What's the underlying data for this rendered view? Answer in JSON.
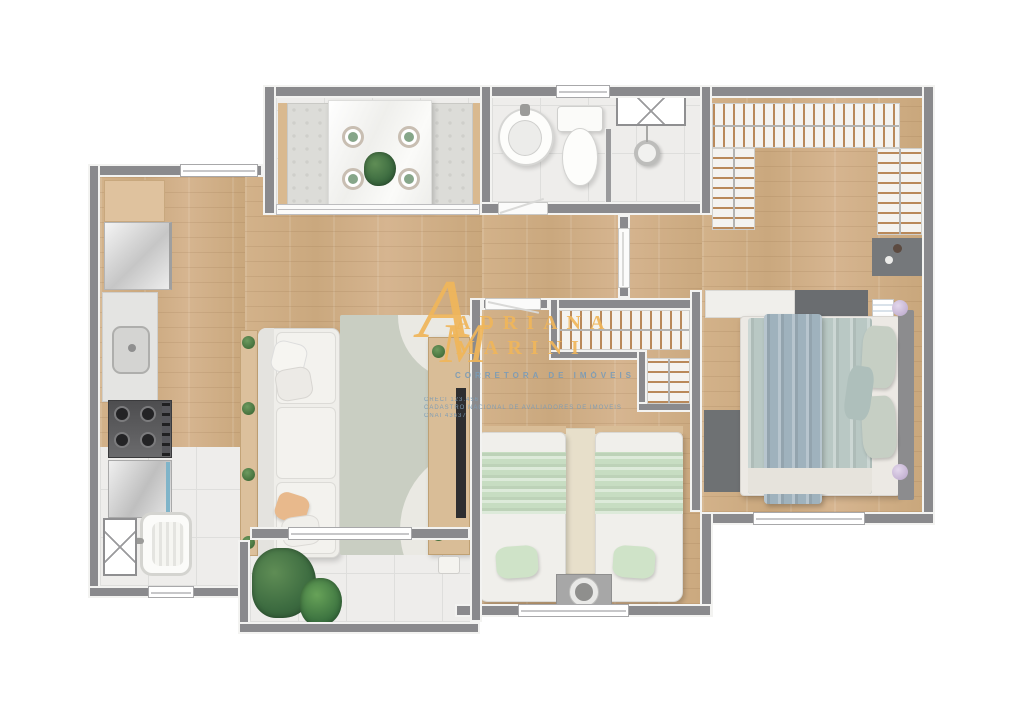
{
  "brand": {
    "monogram_letter1": "A",
    "monogram_letter2": "M",
    "name_line1": "ADRIANA",
    "name_line2": "MARINI",
    "tagline": "CORRETORA DE IMÓVEIS",
    "detail_line1": "CRECI 123.456",
    "detail_line2": "CADASTRO NACIONAL DE AVALIADORES DE IMÓVEIS",
    "detail_line3": "CNAI 43637"
  },
  "palette": {
    "wall_gray": "#8a8a8d",
    "wall_lining": "#f3f3f1",
    "wood_floor": "#d1ae85",
    "tile_floor": "#eeedeb",
    "brand_gold": "#f0b65a",
    "brand_blue": "#7d9cb5",
    "sage_blanket": "#c7ddc2",
    "master_blanket": "#a2b4bd",
    "dark_rug": "#6e7173",
    "beige_rug": "#e7dfca",
    "lamp_lilac": "#cdbbd8"
  },
  "rooms": [
    "gourmet-balcony-dining",
    "bathroom",
    "walk-in-closet",
    "master-bedroom",
    "hallway",
    "second-bedroom",
    "living-room",
    "kitchen",
    "service-area",
    "terrace"
  ]
}
